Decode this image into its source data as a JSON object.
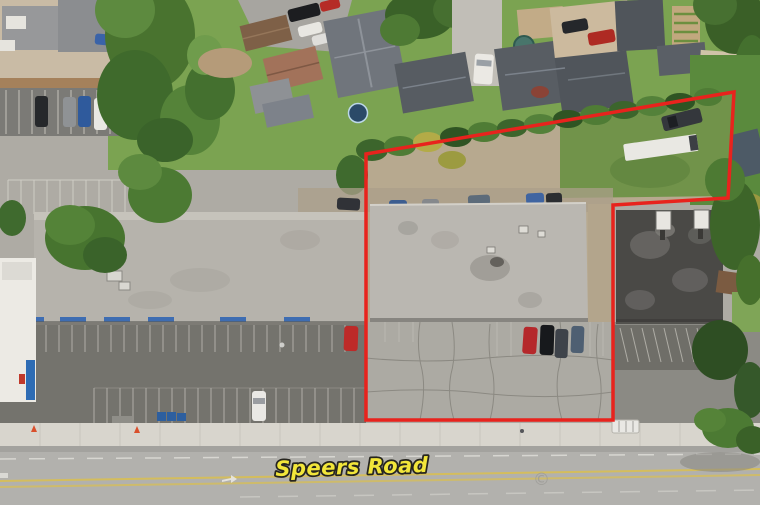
{
  "annotation": {
    "road_label": "Speers Road",
    "watermark_symbol": "©",
    "label_fill": "#f2e63a",
    "label_outline": "#26251f",
    "boundary_color": "#e8231d",
    "boundary_points": "366,154 734,92 728,198 613,205 613,420 366,420"
  },
  "palette": {
    "boundary_red": "#e8231d",
    "label_yellow": "#f2e63a",
    "label_outline_black": "#26251f",
    "road_gray": "#b2b1ad",
    "sidewalk": "#d8d5cd",
    "parking_asphalt": "#74736d",
    "flat_roof_gray": "#b6b3ac",
    "dark_tar_roof": "#4a4946",
    "gravel_lot_tan": "#b7a98f",
    "grass_green": "#7ba351"
  }
}
